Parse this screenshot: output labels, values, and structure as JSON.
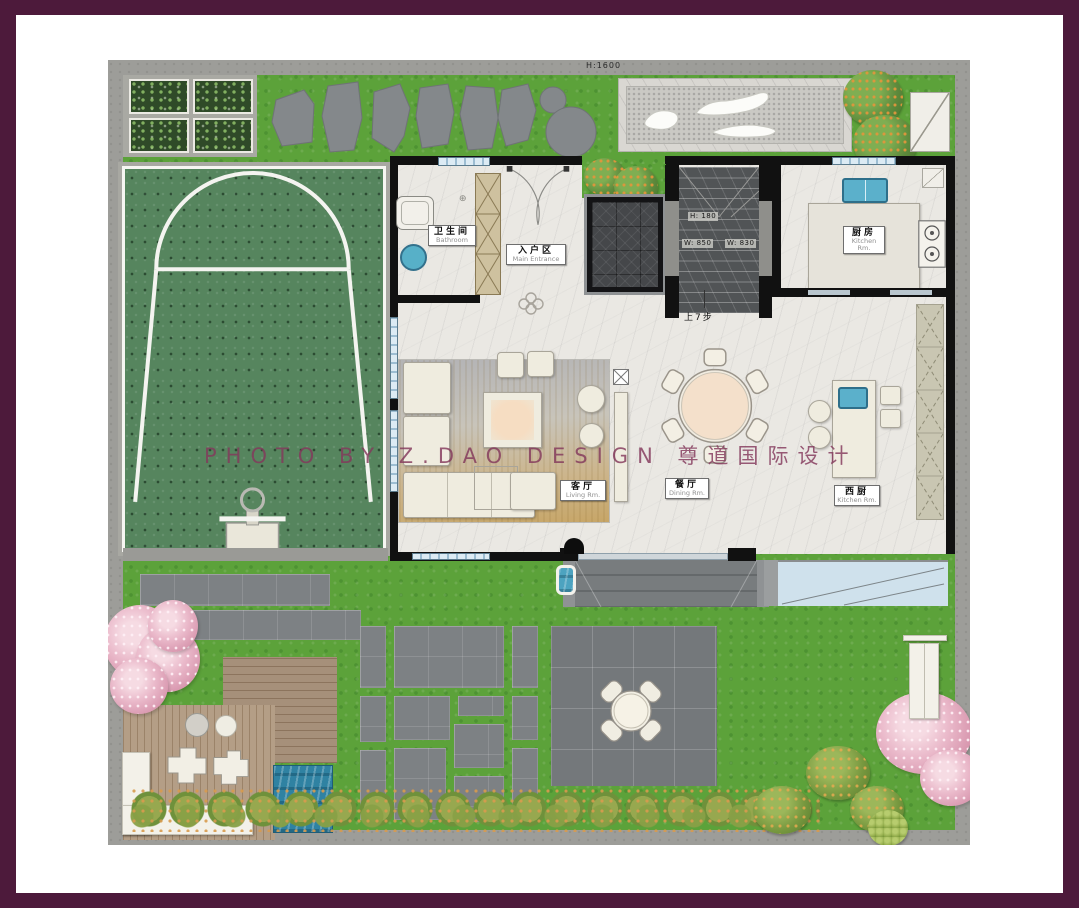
{
  "watermark": "PHOTO BY Z.DAO DESIGN 尊道国际设计",
  "annotations": {
    "fence_height": "H:1600",
    "stair_height": "H: 180",
    "stair_width_left": "W: 850",
    "stair_width_right": "W: 830",
    "stair_note": "上7步"
  },
  "rooms": {
    "bathroom": {
      "cn": "卫生间",
      "en": "Bathroom"
    },
    "entrance": {
      "cn": "入户区",
      "en": "Main Entrance"
    },
    "kitchen": {
      "cn": "厨房",
      "en": "Kitchen Rm."
    },
    "living": {
      "cn": "客厅",
      "en": "Living Rm."
    },
    "dining": {
      "cn": "餐厅",
      "en": "Dining Rm."
    },
    "west_kitchen": {
      "cn": "西厨",
      "en": "Kitchen Rm."
    }
  },
  "palette": {
    "frame": "#4d1a3b",
    "grass": "#5ca23a",
    "court_green": "#56855e",
    "pool_water": "#2f82a2",
    "sink_water": "#57b0c8",
    "marble_floor": "#eae8e3",
    "paver_gray": "#7d8184",
    "deck_wood": "#b49e86",
    "wall_black": "#111111",
    "watermark_text": "#84395c"
  }
}
